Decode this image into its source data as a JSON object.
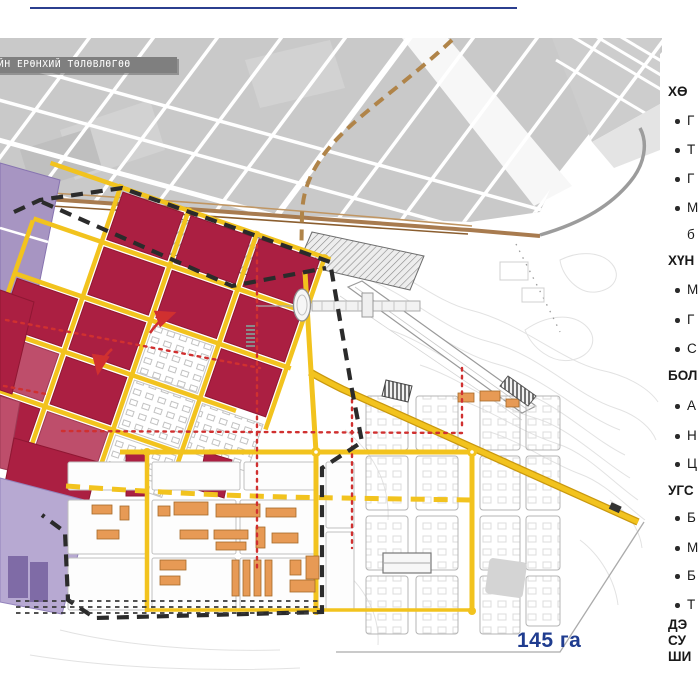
{
  "slide": {
    "banner_text": "ЙН ЕРӨНХИЙ ТӨЛӨВЛӨГӨӨ",
    "area_label": "145 га"
  },
  "palette": {
    "navy": "#1F3C8F",
    "rule_blue": "#2B3F8F",
    "banner_bg": "#7F7F7F",
    "banner_fg": "#FFFFFF",
    "crimson": "#AB1F42",
    "crimson_light": "#BE4E6B",
    "purple": "#A795C2",
    "purple_dark": "#7F6BA6",
    "lavender": "#B7A9D2",
    "road_yellow": "#F2C31E",
    "road_casing": "#C9980F",
    "orange": "#E79A55",
    "orange_stroke": "#A66A28",
    "red_guide": "#D03030",
    "boundary_black": "#2B2B2B",
    "city_gray": "#C9C9C9",
    "brown_road": "#A87B4F",
    "contour_gray": "#E2E2E2"
  },
  "right_panel": {
    "lines": [
      {
        "kind": "heading",
        "text": "ХӨ"
      },
      {
        "kind": "bullet",
        "text": "Г"
      },
      {
        "kind": "bullet",
        "text": "Т"
      },
      {
        "kind": "bullet",
        "text": "Г"
      },
      {
        "kind": "bullet",
        "text": "М"
      },
      {
        "kind": "cont",
        "text": "б"
      },
      {
        "kind": "heading",
        "text": "ХҮН"
      },
      {
        "kind": "bullet",
        "text": "М"
      },
      {
        "kind": "bullet",
        "text": "Г"
      },
      {
        "kind": "bullet",
        "text": "С"
      },
      {
        "kind": "heading",
        "text": "БОЛ"
      },
      {
        "kind": "bullet",
        "text": "А"
      },
      {
        "kind": "bullet",
        "text": "Н"
      },
      {
        "kind": "bullet",
        "text": "Ц"
      },
      {
        "kind": "heading",
        "text": "УГС"
      },
      {
        "kind": "bullet",
        "text": "Б"
      },
      {
        "kind": "bullet",
        "text": "М"
      },
      {
        "kind": "bullet",
        "text": "Б"
      },
      {
        "kind": "bullet",
        "text": "Т"
      },
      {
        "kind": "bold",
        "text": "ДЭ"
      },
      {
        "kind": "bold",
        "text": "СУ"
      },
      {
        "kind": "bold",
        "text": "ШИ"
      }
    ]
  },
  "map": {
    "layers": [
      "existing-city-fabric",
      "brown-corridor-roads",
      "terrain-contours",
      "site-boundary-dashed",
      "residential-blocks-crimson",
      "residential-blocks-purple",
      "yellow-road-network",
      "planned-road-dashed-yellow",
      "red-guideline-axes",
      "orange-public-buildings",
      "hatched-reserved-areas",
      "future-expansion-grid",
      "stadium-oval"
    ]
  }
}
